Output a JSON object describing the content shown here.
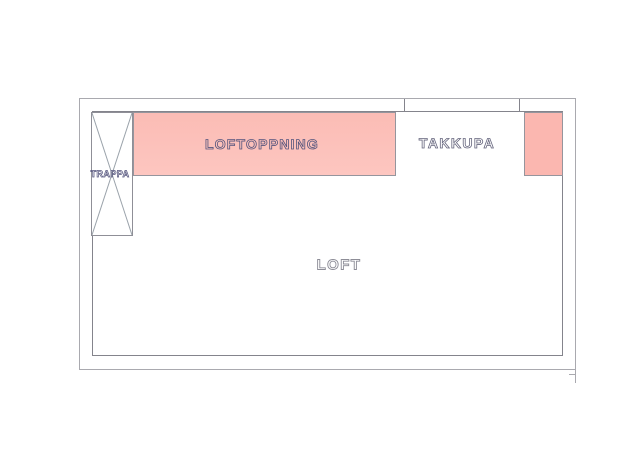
{
  "plan": {
    "labels": {
      "loft": "LOFT",
      "loftoppning": "LOFTOPPNING",
      "takkupa": "TAKKUPA",
      "trappa": "TRAPPA"
    },
    "colors": {
      "outer_line": "#a9a9af",
      "wall_line": "#84848c",
      "stair_line": "#8f8f97",
      "diag_line": "#9aa2aa",
      "highlight_fill": "#fbbcb5",
      "highlight_fill_light": "#fdc6c0",
      "highlight_fill_small": "#fbb7b0",
      "highlight_border": "#95959d",
      "label_navy": "#55557d",
      "label_mid": "#66667e",
      "label_grey": "#8d8d97"
    }
  }
}
